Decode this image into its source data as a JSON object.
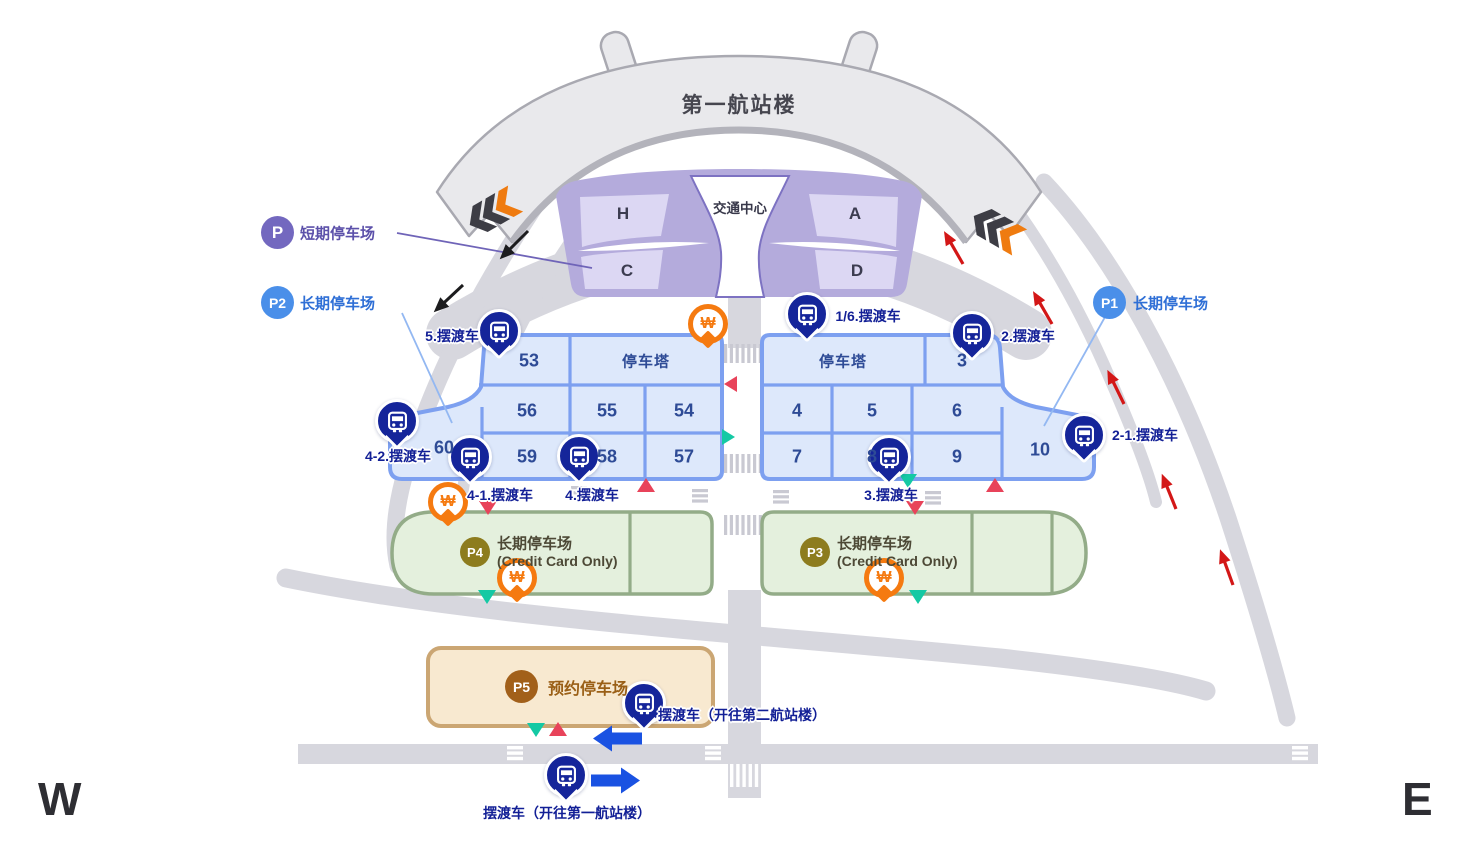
{
  "compass": {
    "west": "W",
    "east": "E"
  },
  "terminal": {
    "title": "第一航站楼"
  },
  "transport_center": {
    "title": "交通中心",
    "zone_h": "H",
    "zone_a": "A",
    "zone_c": "C",
    "zone_d": "D"
  },
  "legend": {
    "short_term_badge": "P",
    "short_term_label": "短期停车场",
    "p2_badge": "P2",
    "p2_label": "长期停车场",
    "p1_badge": "P1",
    "p1_label": "长期停车场"
  },
  "west_lot": {
    "c53": "53",
    "tower": "停车塔",
    "c56": "56",
    "c55": "55",
    "c54": "54",
    "c60": "60",
    "c59": "59",
    "c58": "58",
    "c57": "57"
  },
  "east_lot": {
    "tower": "停车塔",
    "c3": "3",
    "c4": "4",
    "c5": "5",
    "c6": "6",
    "c7": "7",
    "c8": "8",
    "c9": "9",
    "c10": "10"
  },
  "p4": {
    "badge": "P4",
    "label": "长期停车场",
    "sub": "(Credit Card Only)"
  },
  "p3": {
    "badge": "P3",
    "label": "长期停车场",
    "sub": "(Credit Card Only)"
  },
  "p5": {
    "badge": "P5",
    "label": "预约停车场"
  },
  "shuttles": {
    "s5": "5.摆渡车",
    "s16": "1/6.摆渡车",
    "s2": "2.摆渡车",
    "s21": "2-1.摆渡车",
    "s42": "4-2.摆渡车",
    "s41": "4-1.摆渡车",
    "s4": "4.摆渡车",
    "s3": "3.摆渡车",
    "to_t2": "摆渡车（开往第二航站楼）",
    "to_t1": "摆渡车（开往第一航站楼）"
  },
  "icons": {
    "won": "₩"
  },
  "colors": {
    "navy": "#15259a",
    "lot_blue": "#7da0f0",
    "purple": "#b4abdc",
    "green": "#93ac88",
    "orange": "#f57a10",
    "red": "#e8435a",
    "teal": "#14c9a4",
    "road": "#d7d7de"
  }
}
